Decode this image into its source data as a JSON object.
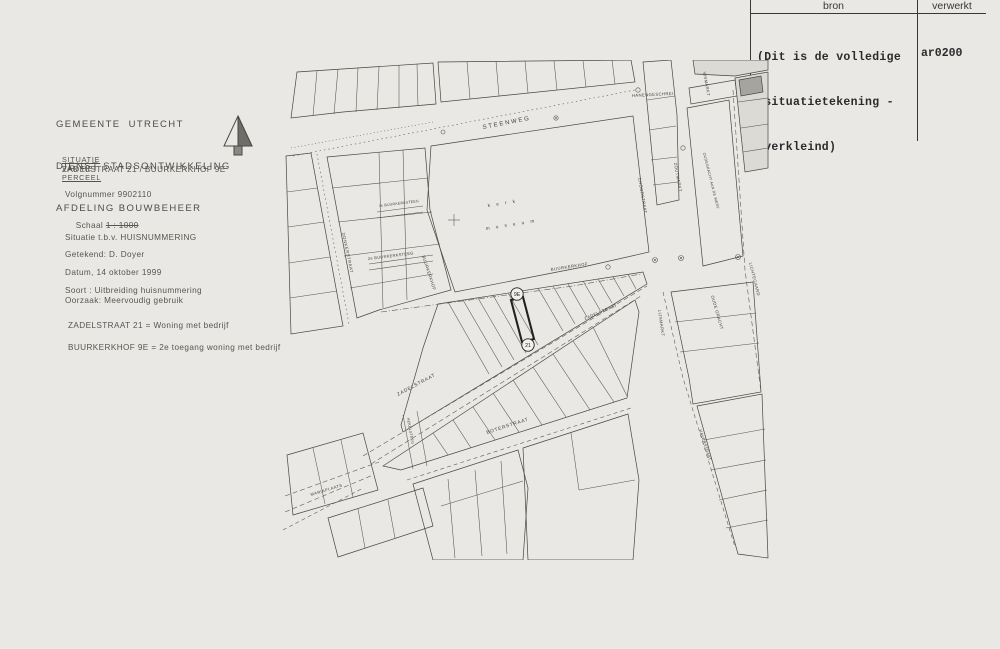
{
  "stamp": {
    "col1": "bron",
    "col2": "verwerkt",
    "note_lines": [
      "(Dit is de volledige",
      " situatietekening -",
      " verkleind)"
    ],
    "code": "ar0200"
  },
  "info": {
    "agency_lines": [
      "GEMEENTE  UTRECHT",
      "DIENST STADSONTWIKKELING",
      "AFDELING BOUWBEHEER"
    ],
    "situatie_parts": [
      "SITUATIE",
      "  VAN  HET  ",
      "PERCEEL"
    ],
    "address": "ZADELSTRAAT 21 / BUURKERKHOF 9E",
    "volgnummer": "Volgnummer 9902110",
    "schaal_label": "Schaal ",
    "schaal_value": "1 : 1000",
    "situatie_tbv": "Situatie t.b.v. HUISNUMMERING",
    "getekend": "Getekend: D. Doyer",
    "datum": "Datum, 14 oktober 1999",
    "soort": "Soort : Uitbreiding huisnummering",
    "oorzaak": "Oorzaak: Meervoudig gebruik",
    "uitleg": [
      "ZADELSTRAAT 21 = Woning met bedrijf",
      "BUURKERKHOF 9E = 2e toegang woning met bedrijf"
    ]
  },
  "map": {
    "parcel": {
      "top_badge": "9E",
      "bottom_badge": "21"
    },
    "labels": [
      {
        "id": "steenweg",
        "text": "STEENWEG",
        "x": 200,
        "y": 69,
        "r": -11,
        "s": 6,
        "ls": 1.8
      },
      {
        "id": "hanengeschrei",
        "text": "HANENGESCHREI",
        "x": 349,
        "y": 37,
        "r": -3,
        "s": 4.2,
        "ls": 0.4
      },
      {
        "id": "vismarkt",
        "text": "VISMARKT",
        "x": 420,
        "y": 12,
        "r": 80,
        "s": 4.2,
        "ls": 0.4
      },
      {
        "id": "choorstraat",
        "text": "CHOORSTRAAT",
        "x": 355,
        "y": 118,
        "r": 80,
        "s": 4.2,
        "ls": 0.4
      },
      {
        "id": "zoutmarkt",
        "text": "ZOUTMARKT",
        "x": 391,
        "y": 103,
        "r": 80,
        "s": 4.2,
        "ls": 0.4
      },
      {
        "id": "oudegracht-werf",
        "text": "OUDEGRACHT AAN DE WERF",
        "x": 420,
        "y": 93,
        "r": 76,
        "s": 3.6,
        "ls": 0.3
      },
      {
        "id": "kerk",
        "text": "k e r k",
        "x": 205,
        "y": 147,
        "r": -9,
        "s": 4.6,
        "ls": 2.5
      },
      {
        "id": "museum",
        "text": "m u s e u m",
        "x": 203,
        "y": 170,
        "r": -9,
        "s": 4.6,
        "ls": 2.5
      },
      {
        "id": "buurkerksteeg-3e",
        "text": "3e BUURKERKSTEEG",
        "x": 96,
        "y": 147,
        "r": -7,
        "s": 3.6,
        "ls": 0.2
      },
      {
        "id": "buurkerksteeg-2e",
        "text": "2e BUURKERKSTEEG",
        "x": 85,
        "y": 200,
        "r": -7,
        "s": 4,
        "ls": 0.3
      },
      {
        "id": "donkerstraat",
        "text": "DONKERSTRAAT",
        "x": 59,
        "y": 173,
        "r": 78,
        "s": 4.2,
        "ls": 0.6
      },
      {
        "id": "buurkerkhof-west",
        "text": "BUURKERKHOF",
        "x": 139,
        "y": 196,
        "r": 72,
        "s": 4.2,
        "ls": 0.4
      },
      {
        "id": "buurkerkhof-noord",
        "text": "BUURKERKHOF",
        "x": 268,
        "y": 211,
        "r": -9,
        "s": 4.2,
        "ls": 0.5
      },
      {
        "id": "zadelstraat-west",
        "text": "ZADELSTRAAT",
        "x": 115,
        "y": 336,
        "r": -28,
        "s": 4.8,
        "ls": 0.8
      },
      {
        "id": "zadelstraat-oost",
        "text": "ZADELSTRAAT",
        "x": 302,
        "y": 260,
        "r": -23,
        "s": 4.2,
        "ls": 0.5
      },
      {
        "id": "lijnmarkt",
        "text": "LIJNMARKT",
        "x": 375,
        "y": 250,
        "r": 82,
        "s": 4.2,
        "ls": 0.4
      },
      {
        "id": "oude-gracht",
        "text": "OUDE GRACHT",
        "x": 428,
        "y": 236,
        "r": 74,
        "s": 4.2,
        "ls": 0.4
      },
      {
        "id": "lichtegaard",
        "text": "LICHTEGAARD",
        "x": 466,
        "y": 203,
        "r": 76,
        "s": 4.2,
        "ls": 0.4
      },
      {
        "id": "boterstraat",
        "text": "BOTERSTRAAT",
        "x": 204,
        "y": 374,
        "r": -18,
        "s": 4.8,
        "ls": 0.8
      },
      {
        "id": "hekelsteeg",
        "text": "HEKELSTEEG",
        "x": 124,
        "y": 358,
        "r": 80,
        "s": 3.6,
        "ls": 0.3
      },
      {
        "id": "mariaplaats",
        "text": "MARIAPLAATS",
        "x": 28,
        "y": 436,
        "r": -17,
        "s": 4,
        "ls": 0.5
      },
      {
        "id": "haverstraat",
        "text": "HAVERSTRAAT",
        "x": 416,
        "y": 370,
        "r": 72,
        "s": 4,
        "ls": 0.3
      }
    ]
  }
}
